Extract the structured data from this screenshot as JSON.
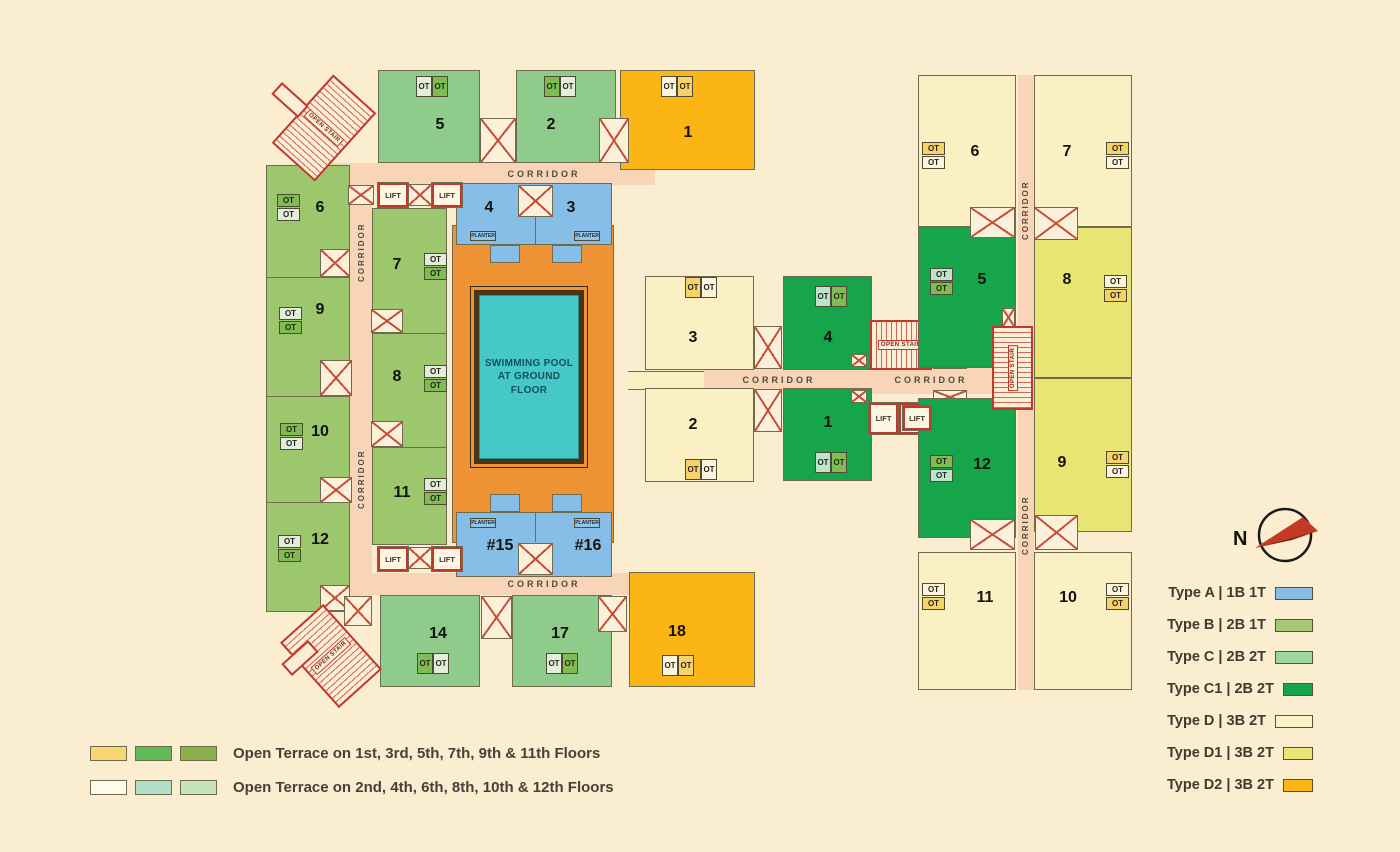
{
  "palette": {
    "background": "#FBEDCF",
    "type_a": "#87BEE8",
    "type_b": "#9CC76C",
    "type_c": "#8FCB8B",
    "type_c1": "#16A54A",
    "type_d": "#FAF0C4",
    "type_d1": "#E9E574",
    "type_d2": "#FBB615",
    "corridor": "#F8D5B6",
    "deck_orange": "#EE9434",
    "pool_teal": "#46C8C8",
    "stair_red": "#C0392B",
    "outline": "#6F6B50",
    "ot_green": "#7FBC51",
    "ot_pale": "#E2EEDA",
    "ot_teal": "#BCE3CC",
    "ot_cream": "#FCF4DC",
    "ot_yellow": "#F6D26A"
  },
  "labels": {
    "corridor": "CORRIDOR",
    "lift": "LIFT",
    "open_stair": "OPEN STAIR",
    "ot": "OT",
    "planter": "PLANTER"
  },
  "pool": {
    "line1": "SWIMMING POOL",
    "line2": "AT GROUND FLOOR"
  },
  "compass": {
    "north": "N"
  },
  "units": {
    "l5": {
      "n": "5",
      "type": "C"
    },
    "l2": {
      "n": "2",
      "type": "C"
    },
    "l1": {
      "n": "1",
      "type": "D2"
    },
    "l4": {
      "n": "4",
      "type": "A"
    },
    "l3": {
      "n": "3",
      "type": "A"
    },
    "l6": {
      "n": "6",
      "type": "B"
    },
    "l9": {
      "n": "9",
      "type": "B"
    },
    "l10": {
      "n": "10",
      "type": "B"
    },
    "l12": {
      "n": "12",
      "type": "B"
    },
    "l7": {
      "n": "7",
      "type": "B"
    },
    "l8": {
      "n": "8",
      "type": "B"
    },
    "l11": {
      "n": "11",
      "type": "B"
    },
    "l15": {
      "n": "#15",
      "type": "A"
    },
    "l16": {
      "n": "#16",
      "type": "A"
    },
    "l14": {
      "n": "14",
      "type": "C"
    },
    "l17": {
      "n": "17",
      "type": "C"
    },
    "l18": {
      "n": "18",
      "type": "D2"
    },
    "m3": {
      "n": "3",
      "type": "D"
    },
    "m2": {
      "n": "2",
      "type": "D"
    },
    "m4": {
      "n": "4",
      "type": "C1"
    },
    "m1": {
      "n": "1",
      "type": "C1"
    },
    "r6": {
      "n": "6",
      "type": "D"
    },
    "r7": {
      "n": "7",
      "type": "D"
    },
    "r5": {
      "n": "5",
      "type": "C1"
    },
    "r8": {
      "n": "8",
      "type": "D1"
    },
    "r12": {
      "n": "12",
      "type": "C1"
    },
    "r9": {
      "n": "9",
      "type": "D1"
    },
    "r11": {
      "n": "11",
      "type": "D"
    },
    "r10": {
      "n": "10",
      "type": "D"
    }
  },
  "type_legend": [
    {
      "label": "Type A | 1B 1T",
      "color": "#87BEE8"
    },
    {
      "label": "Type B | 2B 1T",
      "color": "#A4C873"
    },
    {
      "label": "Type C | 2B 2T",
      "color": "#9ED69B"
    },
    {
      "label": "Type C1 | 2B 2T",
      "color": "#16A54A"
    },
    {
      "label": "Type D | 3B 2T",
      "color": "#FAF3C8"
    },
    {
      "label": "Type D1 | 3B 2T",
      "color": "#EAE678"
    },
    {
      "label": "Type D2 | 3B 2T",
      "color": "#FBB615"
    }
  ],
  "terrace_legend": [
    {
      "swatches": [
        "#F8D772",
        "#5FB954",
        "#8CB04C"
      ],
      "label": "Open Terrace on 1st, 3rd, 5th, 7th, 9th & 11th Floors"
    },
    {
      "swatches": [
        "#FEFBEA",
        "#AFDFC6",
        "#C6E4B8"
      ],
      "label": "Open Terrace on 2nd, 4th, 6th, 8th, 10th & 12th Floors"
    }
  ]
}
